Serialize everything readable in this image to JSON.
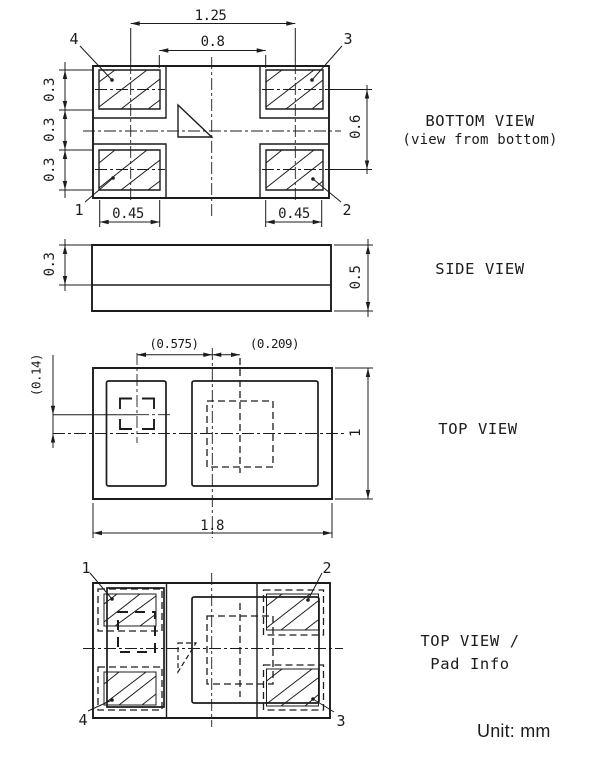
{
  "unit_note": "Unit: mm",
  "colors": {
    "line": "#1c1c1c",
    "bg": "#ffffff"
  },
  "bottom_view": {
    "title": "BOTTOM VIEW",
    "subtitle": "(view from bottom)",
    "dim_pad_pitch_x": "1.25",
    "dim_inner_gap_x": "0.8",
    "dim_pad_h_top": "0.3",
    "dim_mid_gap": "0.3",
    "dim_pad_h_bottom": "0.3",
    "dim_pad_pitch_y": "0.6",
    "dim_pad_w_left": "0.45",
    "dim_pad_w_right": "0.45",
    "pin_tl": "4",
    "pin_tr": "3",
    "pin_bl": "1",
    "pin_br": "2"
  },
  "side_view": {
    "title": "SIDE VIEW",
    "dim_lid_h": "0.3",
    "dim_total_h": "0.5"
  },
  "top_view": {
    "title": "TOP VIEW",
    "dim_offset_left": "(0.575)",
    "dim_offset_right": "(0.209)",
    "dim_offset_y": "(0.14)",
    "dim_width": "1.8",
    "dim_height": "1"
  },
  "pad_info_view": {
    "title": "TOP VIEW /",
    "subtitle": "Pad Info",
    "pin_tl": "1",
    "pin_tr": "2",
    "pin_bl": "4",
    "pin_br": "3"
  }
}
